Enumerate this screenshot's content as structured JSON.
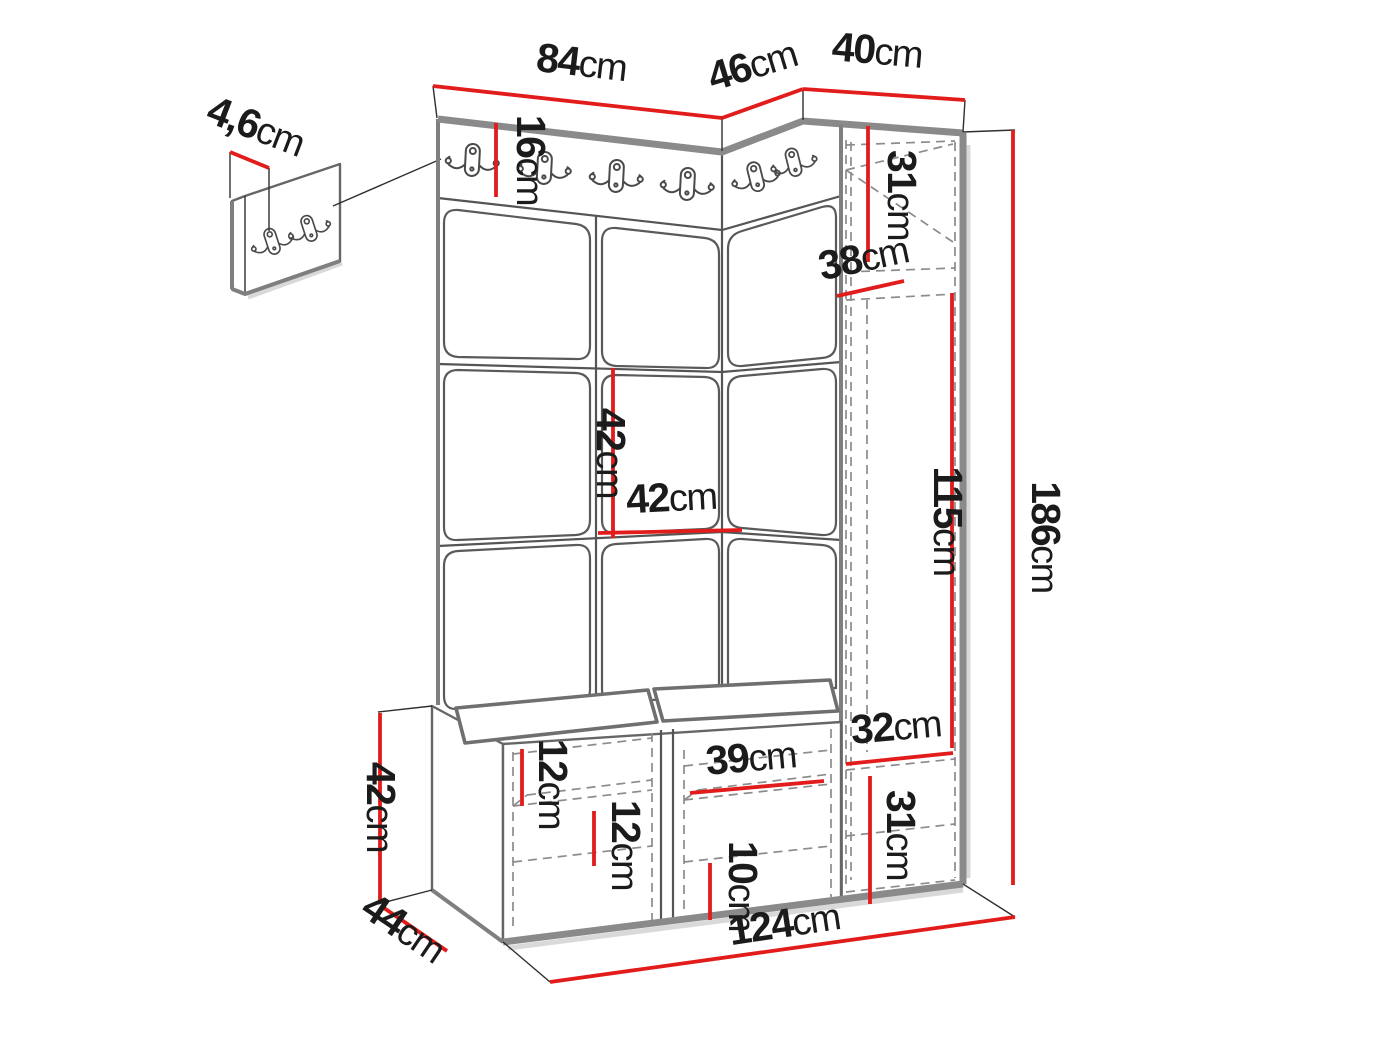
{
  "diagram": "hallway-furniture-set-dimension-drawing",
  "unit_system": "cm",
  "colors": {
    "dimension_line": "#e21b1b",
    "structure_edge": "#8a8a8a",
    "outline": "#555555",
    "hidden_line": "#8c8c8c",
    "text": "#1b1b1b",
    "background": "#ffffff"
  },
  "counts": {
    "wall_hooks": 6,
    "detail_panel_hooks": 2
  },
  "icons": {
    "hook": "double-coat-hook-icon"
  },
  "dims": {
    "w_top_main": {
      "value": "84",
      "unit": "cm"
    },
    "w_top_corner": {
      "value": "46",
      "unit": "cm"
    },
    "w_top_side": {
      "value": "40",
      "unit": "cm"
    },
    "h_hook_rail": {
      "value": "16",
      "unit": "cm"
    },
    "t_hook_panel": {
      "value": "4,6",
      "unit": "cm"
    },
    "h_side_top": {
      "value": "31",
      "unit": "cm"
    },
    "d_side": {
      "value": "38",
      "unit": "cm"
    },
    "h_tile": {
      "value": "42",
      "unit": "cm"
    },
    "w_tile": {
      "value": "42",
      "unit": "cm"
    },
    "h_side_door": {
      "value": "115",
      "unit": "cm"
    },
    "h_total": {
      "value": "186",
      "unit": "cm"
    },
    "w_side_bottom": {
      "value": "32",
      "unit": "cm"
    },
    "h_side_bottom": {
      "value": "31",
      "unit": "cm"
    },
    "gap_bench_left_1": {
      "value": "12",
      "unit": "cm"
    },
    "gap_bench_left_2": {
      "value": "12",
      "unit": "cm"
    },
    "w_bench_mid": {
      "value": "39",
      "unit": "cm"
    },
    "gap_bench_mid": {
      "value": "10",
      "unit": "cm"
    },
    "h_bench": {
      "value": "42",
      "unit": "cm"
    },
    "d_bench": {
      "value": "44",
      "unit": "cm"
    },
    "w_total": {
      "value": "124",
      "unit": "cm"
    }
  }
}
